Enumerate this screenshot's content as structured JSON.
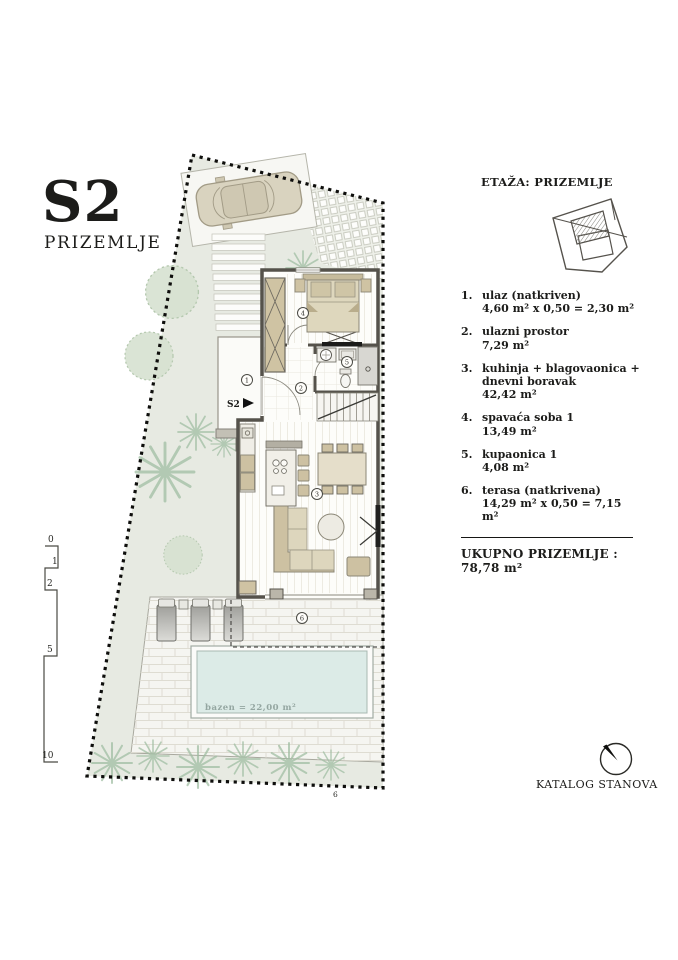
{
  "header": {
    "unit_code": "S2",
    "floor_label": "PRIZEMLJE"
  },
  "info_panel": {
    "etaza_label": "ETAŽA: PRIZEMLJE",
    "legend": [
      {
        "num": "1.",
        "name": "ulaz (natkriven)",
        "area": "4,60 m² x 0,50 = 2,30 m²"
      },
      {
        "num": "2.",
        "name": "ulazni prostor",
        "area": "7,29 m²"
      },
      {
        "num": "3.",
        "name": "kuhinja + blagovaonica + dnevni boravak",
        "area": "42,42 m²"
      },
      {
        "num": "4.",
        "name": "spavaća soba 1",
        "area": "13,49 m²"
      },
      {
        "num": "5.",
        "name": "kupaonica 1",
        "area": "4,08 m²"
      },
      {
        "num": "6.",
        "name": "terasa (natkrivena)",
        "area": "14,29 m² x 0,50 = 7,15 m²"
      }
    ],
    "total_label": "UKUPNO PRIZEMLJE : 78,78 m²",
    "catalog_label": "KATALOG STANOVA"
  },
  "plan": {
    "entry_marker": "S2",
    "room_numbers": [
      "1",
      "2",
      "3",
      "4",
      "5",
      "6"
    ],
    "pool_label": "bazen = 22,00 m²",
    "boundary_mark": "6",
    "scale_ticks": [
      "0",
      "1",
      "2",
      "5",
      "10"
    ]
  },
  "colors": {
    "lawn": "#e7eae2",
    "pool_water": "#dcebe7",
    "furniture_tan": "#cdc1a2",
    "wall_dark": "#55524b",
    "tree_green": "#9fbda1",
    "boundary_black": "#0e0e0c"
  }
}
